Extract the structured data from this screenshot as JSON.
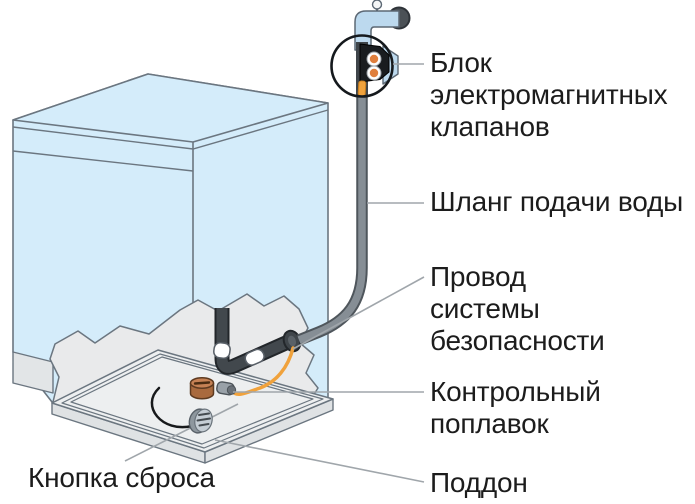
{
  "figure": {
    "type": "technical-diagram",
    "subject": "dishwasher-water-inlet-safety-system",
    "labels": {
      "valve_block": "Блок электромагнитных клапанов",
      "supply_hose": "Шланг подачи воды",
      "safety_wire": "Провод системы безопасности",
      "control_float": "Контрольный поплавок",
      "drip_pan": "Поддон",
      "reset_button": "Кнопка сброса"
    },
    "colors": {
      "machine_blue": "#d4ecfa",
      "faucet_blue": "#bcd9ee",
      "outline_gray": "#6b7680",
      "cutaway_gray": "#e9eaeb",
      "tray_gray": "#edeff0",
      "tray_side_gray": "#dfe2e4",
      "hose_gray": "#868e95",
      "hose_edge": "#4f565c",
      "inner_hose_dark": "#42484d",
      "wire_orange": "#f0a23c",
      "float_brown": "#a96a3e",
      "float_top_brown": "#c58154",
      "button_gray": "#c5cdd4",
      "leader_gray": "#a0a6ab",
      "valve_black": "#191c1f",
      "valve_orange": "#df7e3c",
      "text_black": "#1c1c1c"
    }
  }
}
